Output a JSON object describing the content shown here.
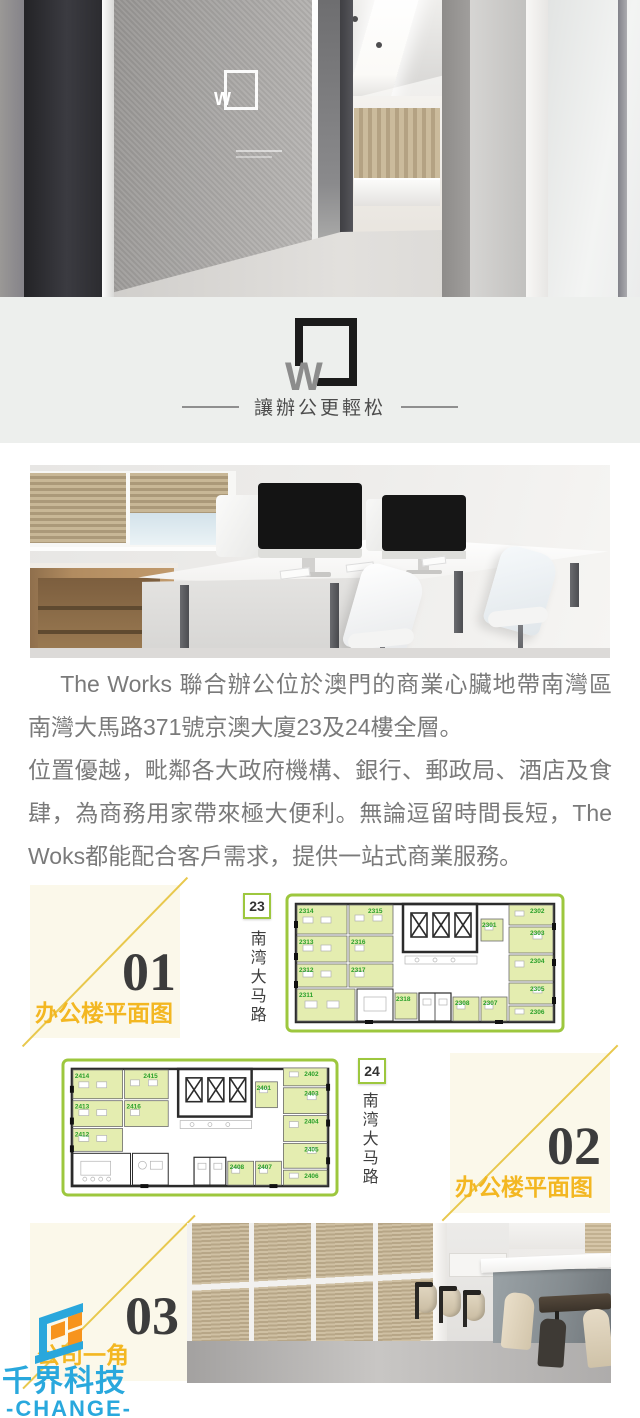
{
  "brand": {
    "logo_letter": "W",
    "tagline": "讓辦公更輕松"
  },
  "intro": {
    "paragraph1": "The Works 聯合辦公位於澳門的商業心臟地帶南灣區南灣大馬路371號京澳大廈23及24樓全層。",
    "paragraph2": "位置優越，毗鄰各大政府機構、銀行、郵政局、酒店及食肆，為商務用家帶來極大便利。無論逗留時間長短，The Woks都能配合客戶需求，提供一站式商業服務。"
  },
  "sections": {
    "one": {
      "number": "01",
      "title": "办公楼平面图"
    },
    "two": {
      "number": "02",
      "title": "办公楼平面图"
    },
    "three": {
      "number": "03",
      "title": "公司一角"
    }
  },
  "floor23": {
    "badge": "23",
    "street": "南湾大马路",
    "rooms": [
      "2314",
      "2315",
      "2313",
      "2316",
      "2312",
      "2317",
      "2311",
      "2318",
      "2301",
      "2302",
      "2303",
      "2304",
      "2305",
      "2306",
      "2307",
      "2308"
    ]
  },
  "floor24": {
    "badge": "24",
    "street": "南湾大马路",
    "rooms": [
      "2414",
      "2415",
      "2413",
      "2416",
      "2412",
      "2401",
      "2402",
      "2403",
      "2404",
      "2405",
      "2406",
      "2407",
      "2408"
    ]
  },
  "watermark": {
    "company": "千界科技",
    "brand": "-CHANGE-"
  },
  "colors": {
    "accent_gold": "#f3b722",
    "panel_cream": "#fbf8ea",
    "diagonal_yellow": "#e8c84d",
    "plan_border_green": "#9dc73e",
    "room_label_green": "#2aa02a",
    "room_fill_green": "#e4edb0",
    "logo_blue": "#29a8dd",
    "logo_orange": "#f7941d",
    "band_gray": "#edefed",
    "text_gray": "#7a7a7a"
  }
}
